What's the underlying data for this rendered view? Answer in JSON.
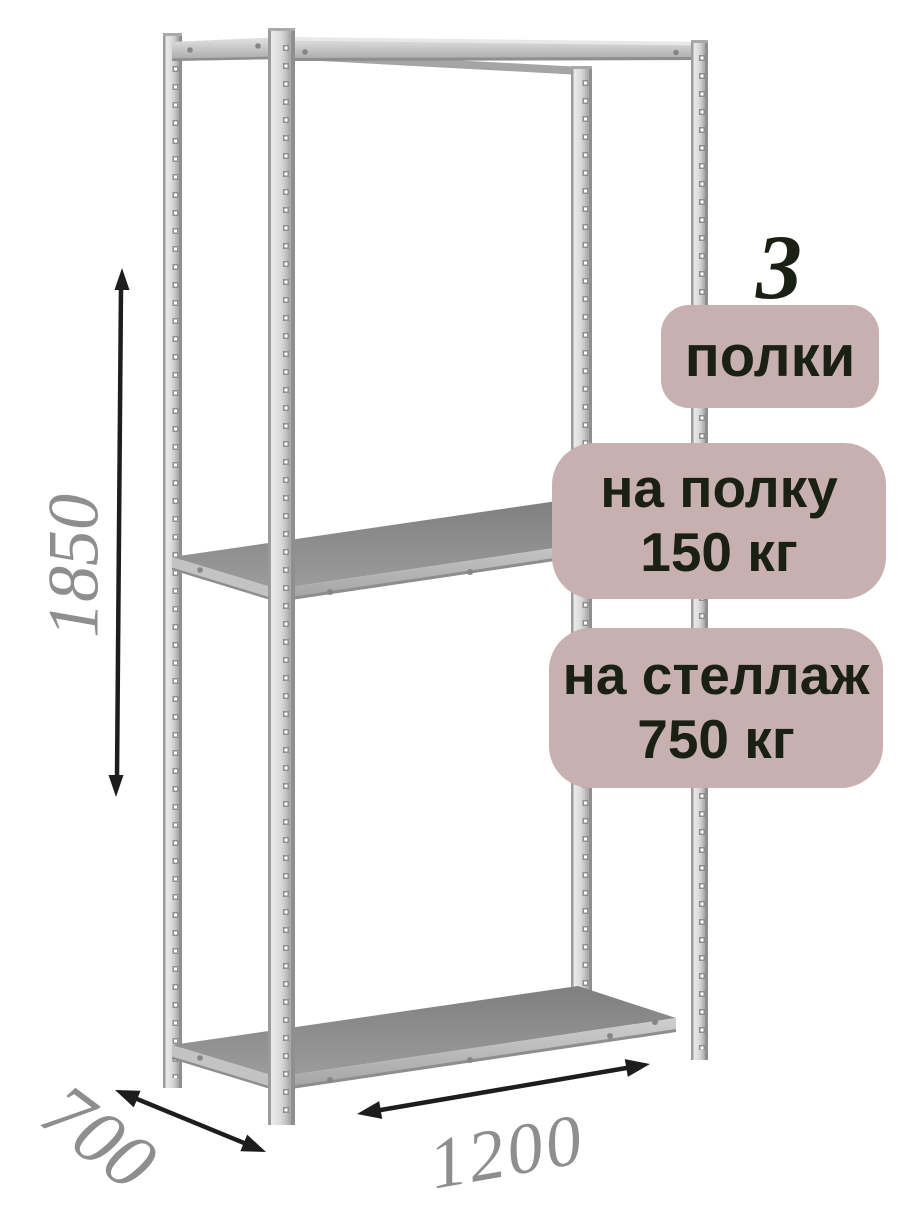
{
  "badges": {
    "count": {
      "value": "3",
      "label": "полки"
    },
    "shelf_load": {
      "line1": "на полку",
      "line2": "150 кг"
    },
    "rack_load": {
      "line1": "на стеллаж",
      "line2": "750 кг"
    }
  },
  "dimensions": {
    "height_mm": "1850",
    "depth_mm": "700",
    "width_mm": "1200"
  },
  "icons": {
    "height_arrow": "double-arrow-vertical",
    "depth_arrow": "double-arrow-diagonal",
    "width_arrow": "double-arrow-horizontal"
  },
  "colors": {
    "background": "#ffffff",
    "badge_bg": "#c8b0b0",
    "badge_text": "#1a2014",
    "dim_text": "#8e8e8e",
    "arrow": "#1d1d1d",
    "metal_light": "#e9e9e9",
    "metal_mid": "#c6c6c6",
    "metal_dark": "#9a9a9a",
    "shelf_top": "#868686"
  }
}
